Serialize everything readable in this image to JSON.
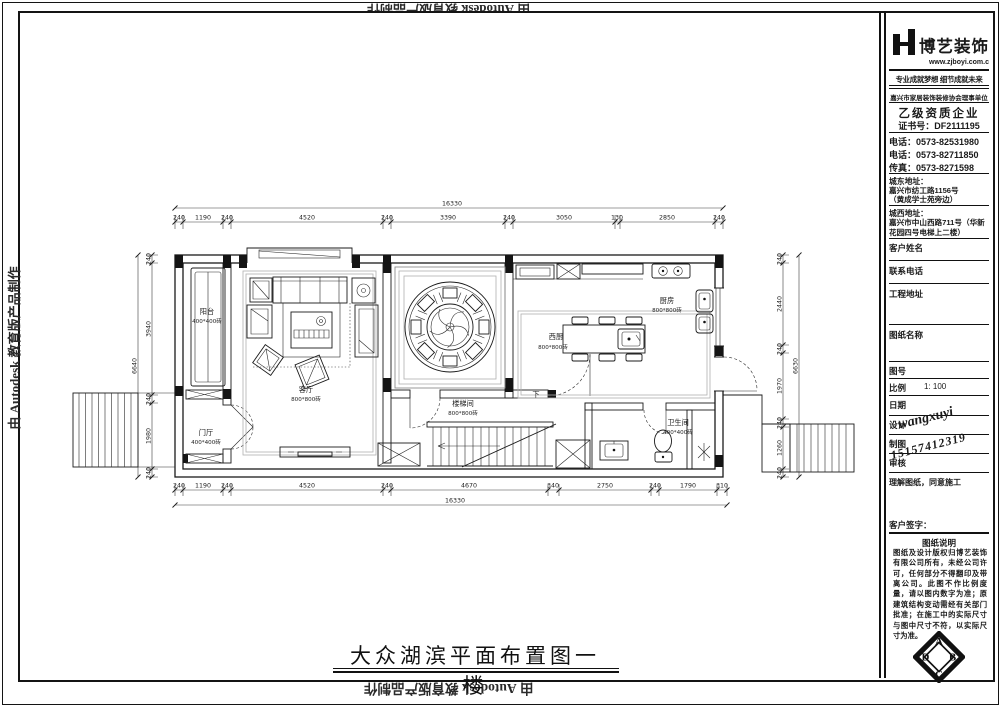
{
  "banners": {
    "autodesk": "由 Autodesk 教育版产品制作"
  },
  "title": "大众湖滨平面布置图一楼",
  "colors": {
    "ink": "#1a1a1a",
    "paper": "#ffffff"
  },
  "company": {
    "logo_text": "博艺装饰",
    "website": "www.zjboyi.com.c",
    "slogan": "专业成就梦想 细节成就未来",
    "association": "嘉兴市家居装饰装修协会理事单位",
    "grade": "乙级资质企业",
    "cert_no": "证书号：DF2111195",
    "phone1": "电话：0573-82531980",
    "phone2": "电话：0573-82711850",
    "fax": "传真：0573-8271598",
    "addr_east_label": "城东地址：",
    "addr_east_1": "嘉兴市纺工路1156号",
    "addr_east_2": "（黄成学士苑旁边）",
    "addr_west_label": "城西地址：",
    "addr_west": "嘉兴市中山西路711号（华新花园四号电梯上二楼）"
  },
  "fields": {
    "customer": "客户姓名",
    "phone": "联系电话",
    "address": "工程地址",
    "drawing_name": "图纸名称",
    "drawing_no": "图号",
    "scale_label": "比例",
    "scale_value": "1: 100",
    "date": "日期",
    "design": "设计",
    "draft": "制图",
    "review": "审核",
    "agree": "理解图纸，同意施工",
    "sign_label": "客户签字："
  },
  "signature": {
    "name": "wangxuyi",
    "number": "15157412319"
  },
  "notes": {
    "title": "图纸说明",
    "body": "图纸及设计版权归博艺装饰有限公司所有，未经公司许可，任何部分不得翻印及带离公司。此图不作比例度量，请以图内数字为准；原建筑结构变动需经有关部门批准；在施工中的实际尺寸与图中尺寸不符，以实际尺寸为准。"
  },
  "stamp": {
    "top": "A",
    "right": "B",
    "bottom": "C",
    "left": "D"
  },
  "plan": {
    "rooms": {
      "balcony": {
        "name": "阳台",
        "tile": "400*400砖"
      },
      "foyer": {
        "name": "门厅",
        "tile": "400*400砖"
      },
      "living": {
        "name": "客厅",
        "tile": "800*800砖"
      },
      "stair": {
        "name": "楼梯间",
        "tile": "800*800砖"
      },
      "west_kitchen": {
        "name": "西厨",
        "tile": "800*800砖"
      },
      "kitchen": {
        "name": "厨房",
        "tile": "800*800砖"
      },
      "bath": {
        "name": "卫生间",
        "tile": "400*400砖"
      },
      "down": "下"
    },
    "dims": {
      "top": [
        "240",
        "1190",
        "240",
        "4520",
        "240",
        "3390",
        "240",
        "3050",
        "130",
        "2850",
        "240"
      ],
      "top_total": "16330",
      "bottom": [
        "240",
        "1190",
        "240",
        "4520",
        "240",
        "4670",
        "340",
        "2750",
        "240",
        "1790",
        "310"
      ],
      "bottom_total": "16330",
      "left": [
        "240",
        "3940",
        "240",
        "1980",
        "240"
      ],
      "left_total": "6640",
      "right": [
        "240",
        "2440",
        "240",
        "1970",
        "240",
        "1260",
        "240"
      ],
      "right_total": "6630"
    }
  }
}
